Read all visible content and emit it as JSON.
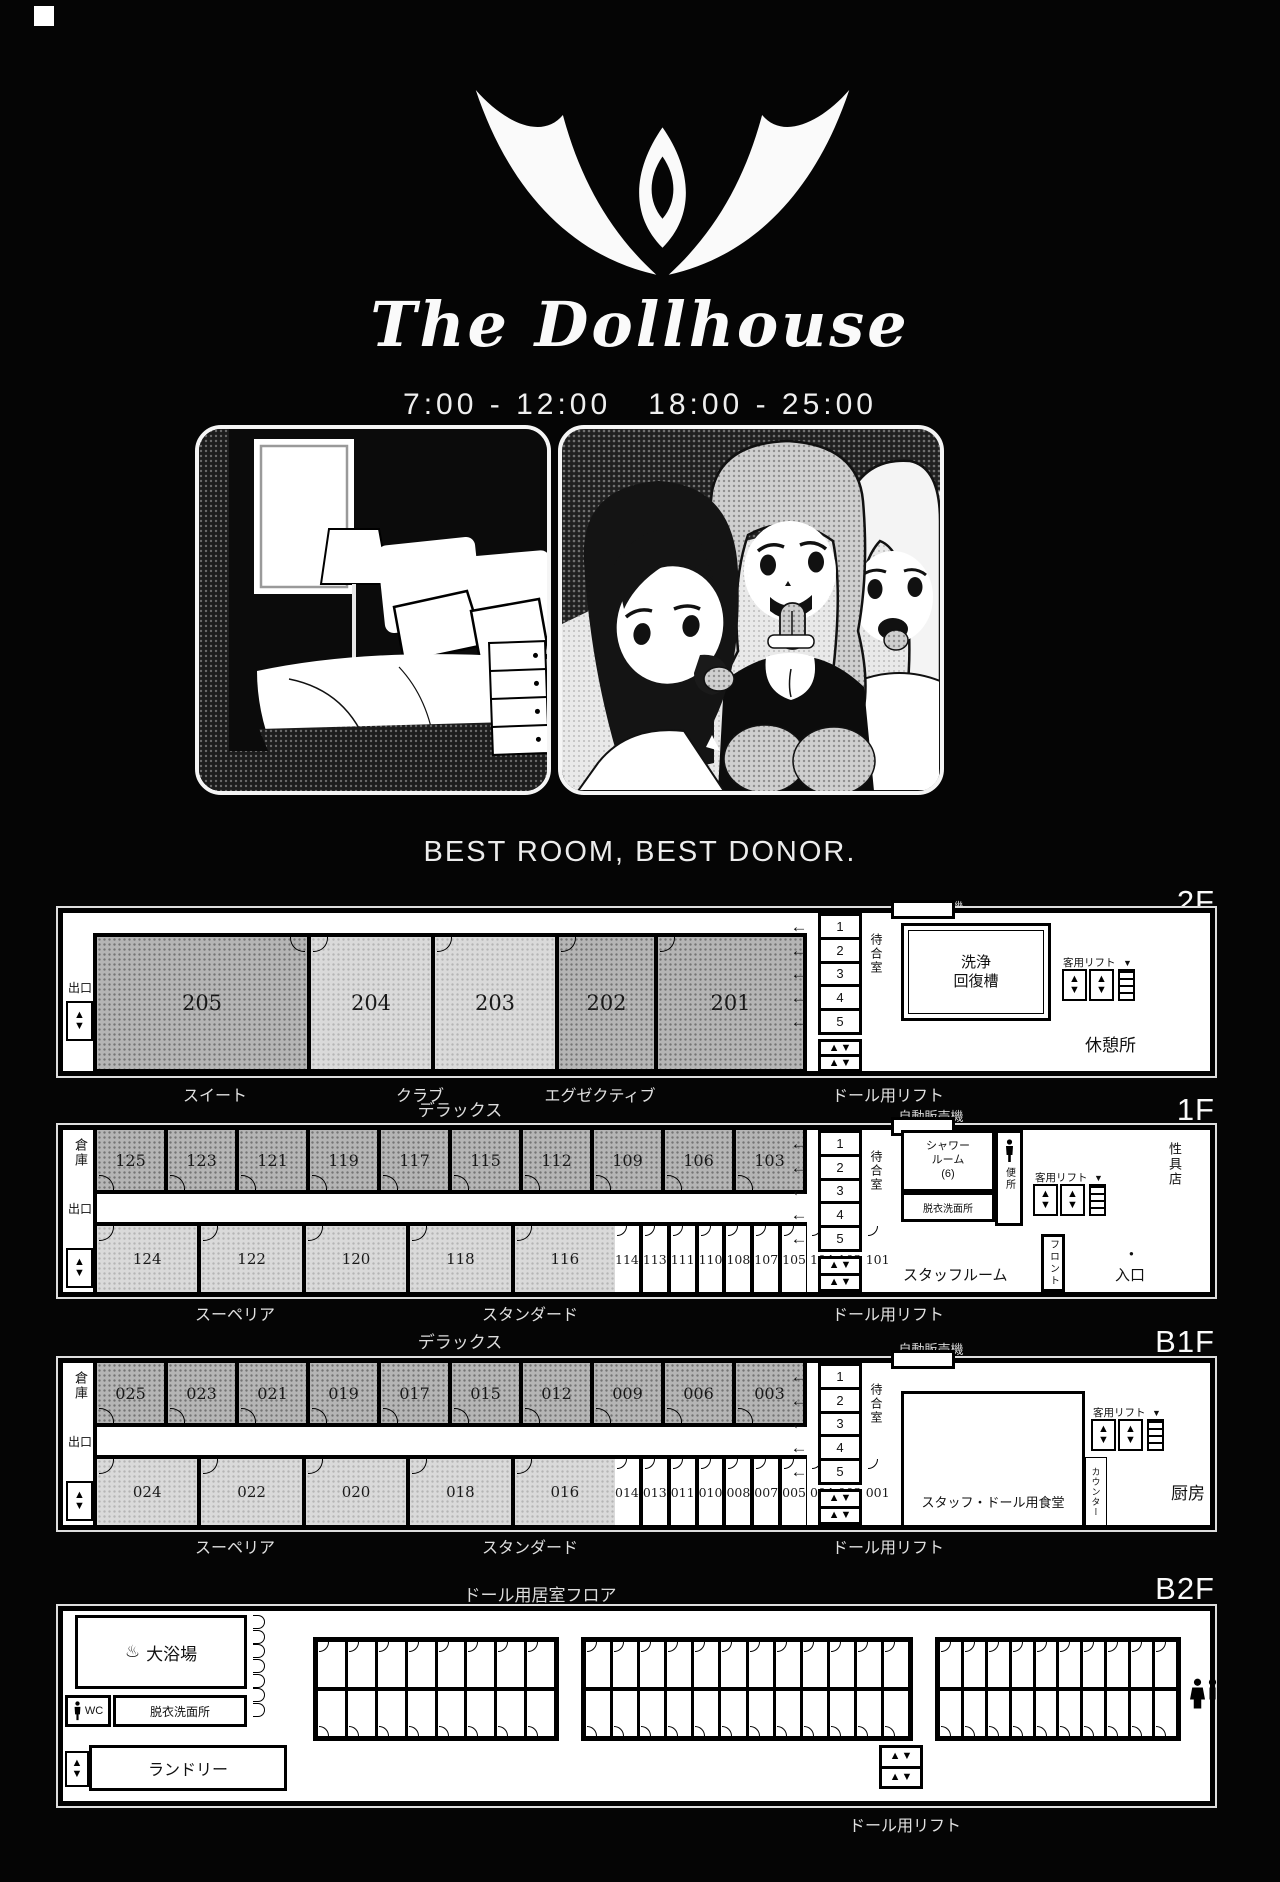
{
  "page": {
    "brand_script": "The Dollhouse",
    "hours": "7:00 - 12:00   18:00 - 25:00",
    "tagline": "BEST ROOM, BEST DONOR."
  },
  "labels": {
    "vending": "自動販売機",
    "waiting": "待合室",
    "guest_lift": "客用リフト",
    "doll_lift": "ドール用リフト",
    "exit": "出口",
    "storage": "倉庫",
    "deluxe": "デラックス",
    "superior": "スーペリア",
    "standard": "スタンダード",
    "stalls": [
      "1",
      "2",
      "3",
      "4",
      "5"
    ]
  },
  "icons": {
    "up": "▲",
    "down": "▼",
    "arrow_left": "←",
    "onsen": "♨",
    "door_dot": "●"
  },
  "f2": {
    "tag": "2F",
    "rooms": [
      {
        "num": "205",
        "cls": "dark r205 arc-tr"
      },
      {
        "num": "204",
        "cls": "light r204 arc-tl"
      },
      {
        "num": "203",
        "cls": "light r203 arc-tl"
      },
      {
        "num": "202",
        "cls": "dark r202 arc-tl"
      },
      {
        "num": "201",
        "cls": "dark r201 arc-tl"
      }
    ],
    "washing_1": "洗浄",
    "washing_2": "回復槽",
    "rest": "休憩所",
    "cat_suite": "スイート",
    "cat_club": "クラブ",
    "cat_exec": "エグゼクティブ"
  },
  "f1": {
    "tag": "1F",
    "rooms_top": [
      "125",
      "123",
      "121",
      "119",
      "117",
      "115",
      "112",
      "109",
      "106",
      "103"
    ],
    "rooms_sup": [
      "124",
      "122",
      "120",
      "118",
      "116"
    ],
    "rooms_std": [
      "114",
      "113",
      "111",
      "110",
      "108",
      "107",
      "105",
      "104",
      "102",
      "101"
    ],
    "shower_1": "シャワー",
    "shower_2": "ルーム",
    "shower_3": "(6)",
    "dressing": "脱衣洗面所",
    "toilet": "便所",
    "toy_shop": "性具店",
    "staff_room": "スタッフルーム",
    "front_desk": "フロント",
    "entrance": "入口"
  },
  "b1": {
    "tag": "B1F",
    "rooms_top": [
      "025",
      "023",
      "021",
      "019",
      "017",
      "015",
      "012",
      "009",
      "006",
      "003"
    ],
    "rooms_sup": [
      "024",
      "022",
      "020",
      "018",
      "016"
    ],
    "rooms_std": [
      "014",
      "013",
      "011",
      "010",
      "008",
      "007",
      "005",
      "004",
      "002",
      "001"
    ],
    "canteen": "スタッフ・ドール用食堂",
    "counter": "カウンター",
    "kitchen": "厨房"
  },
  "b2": {
    "tag": "B2F",
    "title": "ドール用居室フロア",
    "bath": "大浴場",
    "wc": "WC",
    "dressing": "脱衣洗面所",
    "laundry": "ランドリー",
    "capsule_blocks": [
      8,
      12,
      10
    ]
  }
}
